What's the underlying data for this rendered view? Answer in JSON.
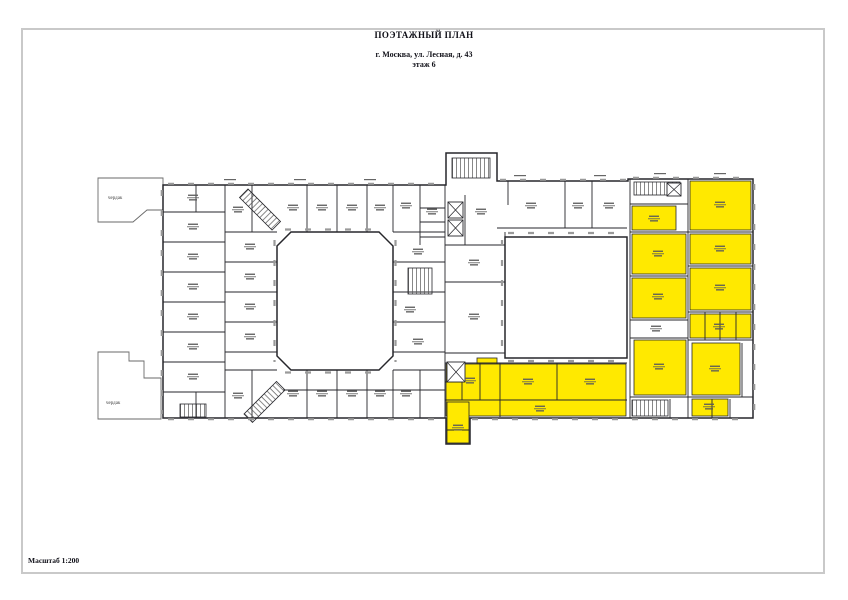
{
  "page": {
    "title": "ПОЭТАЖНЫЙ ПЛАН",
    "address": "г. Москва, ул. Лесная, д. 43",
    "floor_label": "этаж 6",
    "scale_label": "Масштаб 1:200"
  },
  "plan": {
    "labels": {
      "attic_top": "чердак",
      "attic_bottom": "чердак"
    },
    "colors": {
      "highlight": "#ffe900",
      "wall": "#26262b",
      "window_tick": "#9a9a9a",
      "frame": "#c9c9c9",
      "text": "#101018"
    }
  }
}
